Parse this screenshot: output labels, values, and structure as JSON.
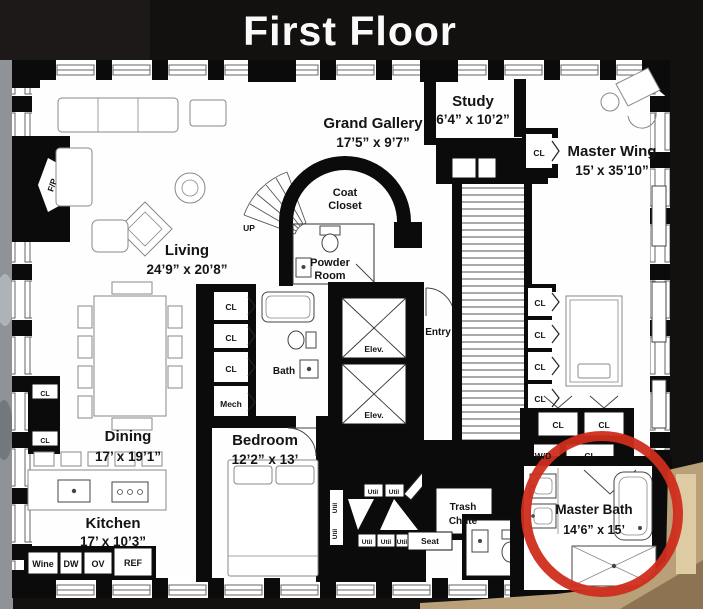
{
  "title": "First Floor",
  "rooms": {
    "grand_gallery": {
      "name": "Grand Gallery",
      "dims": "17’5” x 9’7”"
    },
    "study": {
      "name": "Study",
      "dims": "6’4” x 10’2”"
    },
    "master_wing": {
      "name": "Master Wing",
      "dims": "15’ x 35’10”"
    },
    "living": {
      "name": "Living",
      "dims": "24’9” x 20’8”"
    },
    "dining": {
      "name": "Dining",
      "dims": "17’ x 19’1”"
    },
    "kitchen": {
      "name": "Kitchen",
      "dims": "17’ x 10’3”"
    },
    "bedroom": {
      "name": "Bedroom",
      "dims": "12’2” x 13’"
    },
    "master_bath": {
      "name": "Master Bath",
      "dims": "14’6” x 15’"
    },
    "coat_closet": {
      "line1": "Coat",
      "line2": "Closet"
    },
    "powder_room": {
      "line1": "Powder",
      "line2": "Room"
    },
    "bath": {
      "name": "Bath"
    },
    "entry": {
      "name": "Entry"
    },
    "trash_chute": {
      "line1": "Trash",
      "line2": "Chute"
    }
  },
  "labels": {
    "up": "UP",
    "fireplace": "F/P",
    "closet": "CL",
    "mech": "Mech",
    "elevator": "Elev.",
    "washer_dryer": "W/D",
    "seat": "Seat",
    "utility": "Util",
    "wine": "Wine",
    "dishwasher": "DW",
    "oven": "OV",
    "refrigerator": "REF"
  },
  "annotation": {
    "highlight_color": "#cf2d1c"
  }
}
